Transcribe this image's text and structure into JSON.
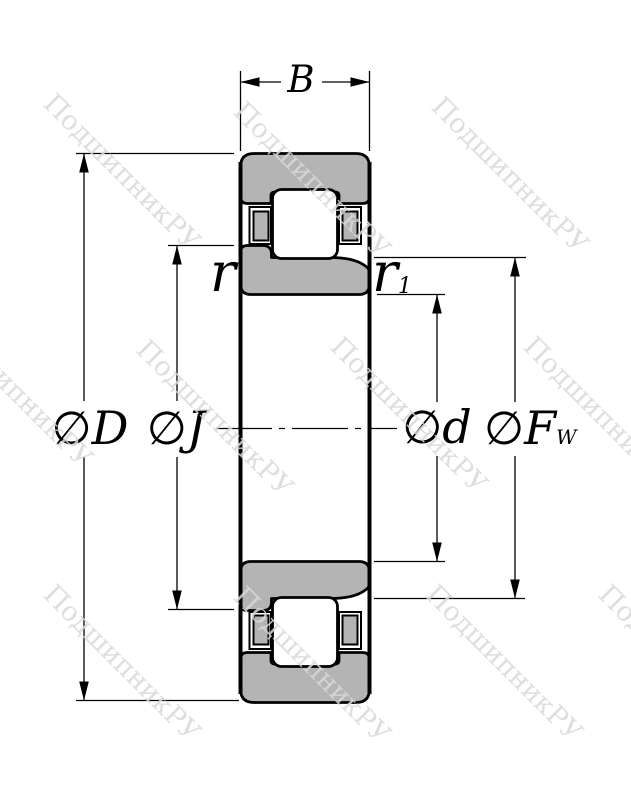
{
  "watermark": {
    "text": "ПодшипникРУ",
    "color": "#d9d9d9"
  },
  "drawing": {
    "description": "cylindrical-roller-bearing-cross-section",
    "labels": {
      "width": "B",
      "outer_diameter": "∅D",
      "flange_diameter": "∅J",
      "bore_diameter": "∅d",
      "raceway_diameter": "∅F",
      "raceway_diameter_sub": "W",
      "chamfer_outer": "r",
      "chamfer_inner": "r",
      "chamfer_inner_sub": "1"
    },
    "colors": {
      "ring_fill": "#b4b4b4",
      "roller_fill": "#ffffff",
      "outline": "#000000",
      "background": "#ffffff"
    }
  }
}
